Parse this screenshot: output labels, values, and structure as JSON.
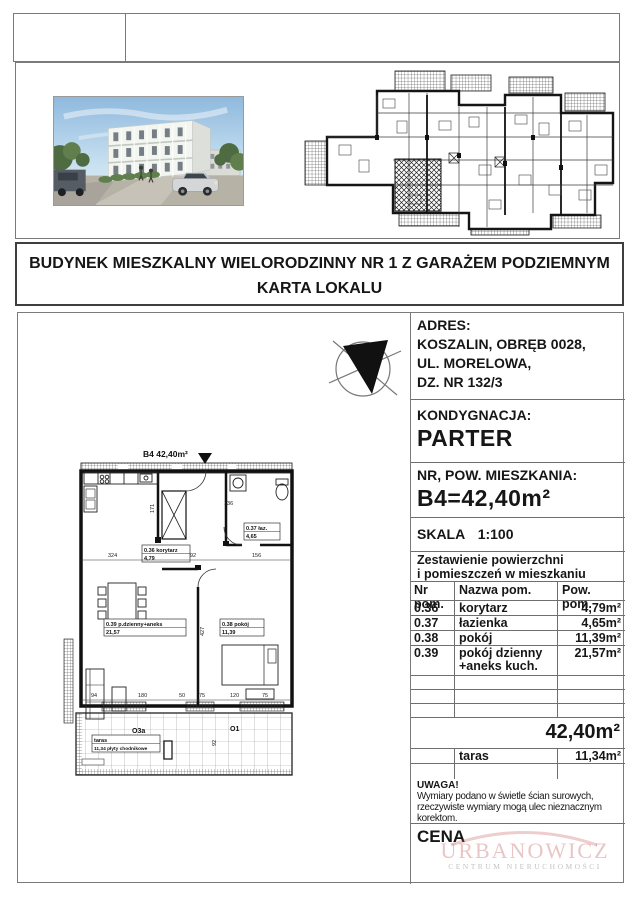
{
  "document": {
    "title_line1": "BUDYNEK MIESZKALNY WIELORODZINNY  NR 1 Z  GARAŻEM PODZIEMNYM",
    "title_line2": "KARTA   LOKALU"
  },
  "address": {
    "label": "ADRES:",
    "line1": "KOSZALIN,  OBRĘB  0028,",
    "line2": "UL. MORELOWA,",
    "line3": "DZ. NR 132/3"
  },
  "floor": {
    "label": "KONDYGNACJA:",
    "value": "PARTER"
  },
  "unit": {
    "label": "NR, POW. MIESZKANIA:",
    "value": "B4=42,40m²"
  },
  "scale": {
    "label": "SKALA",
    "value": "1:100"
  },
  "summary": {
    "line1": "Zestawienie powierzchni",
    "line2": "i pomieszczeń w mieszkaniu"
  },
  "table": {
    "col_nr": "Nr pom.",
    "col_name": "Nazwa pom.",
    "col_area": "Pow. pom.",
    "rows": [
      {
        "nr": "0.36",
        "name": "korytarz",
        "area": "4,79m²"
      },
      {
        "nr": "0.37",
        "name": "łazienka",
        "area": "4,65m²"
      },
      {
        "nr": "0.38",
        "name": "pokój",
        "area": "11,39m²"
      },
      {
        "nr": "0.39",
        "name": "pokój dzienny",
        "name2": "+aneks kuch.",
        "area": "21,57m²"
      }
    ],
    "total": "42,40m²",
    "taras_name": "taras",
    "taras_area": "11,34m²"
  },
  "note": {
    "label": "UWAGA!",
    "line1": "Wymiary podano w świetle ścian surowych,",
    "line2": "rzeczywiste wymiary mogą ulec nieznacznym",
    "line3": "korektom."
  },
  "price": {
    "label": "CENA"
  },
  "watermark": {
    "name": "URBANOWICZ",
    "subtitle": "CENTRUM NIERUCHOMOŚCI"
  },
  "colors": {
    "watermark_red": "#ce8080",
    "watermark_gray": "#949e94",
    "line_gray": "#6e6e6e"
  },
  "plan": {
    "title": "B4 42,40m²",
    "rooms": {
      "korytarz": {
        "l1": "0.36 korytarz",
        "l2": "4,79"
      },
      "lazienka": {
        "l1": "0.37 łaz.",
        "l2": "4,65"
      },
      "dzienny": {
        "l1": "0.39 p.dzienny+aneks",
        "l2": "21,57"
      },
      "pokoj": {
        "l1": "0.38 pokój",
        "l2": "11,39"
      },
      "taras": {
        "l1": "taras",
        "l2": "11,34 płyty chodnikowe"
      }
    },
    "windows": {
      "w1": "O3a",
      "w2": "O1"
    },
    "dims": {
      "d324": "324",
      "d92": "92",
      "d156": "156",
      "d171": "171",
      "d136": "136",
      "d427": "427",
      "b94": "94",
      "b180": "180",
      "b50": "50",
      "b75a": "75",
      "b120": "120",
      "b75b": "75",
      "t92": "92"
    }
  }
}
